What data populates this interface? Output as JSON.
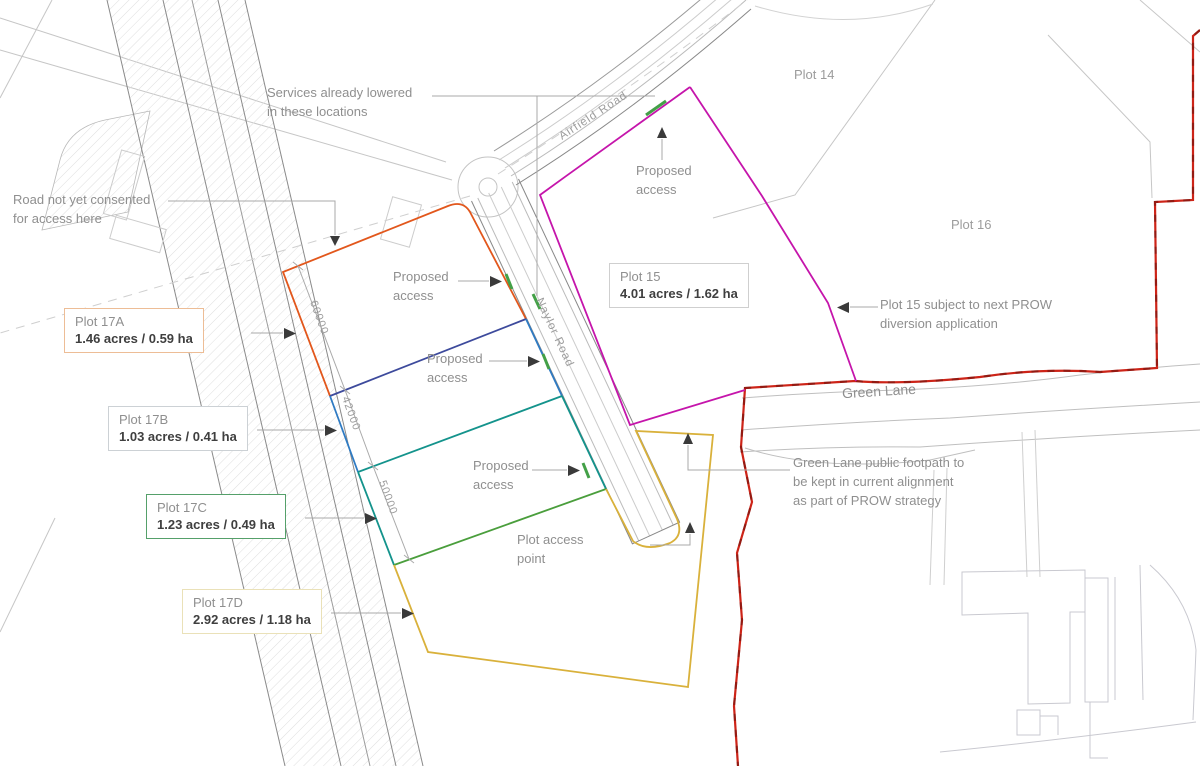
{
  "annotations": {
    "services_note": "Services already lowered\nin these locations",
    "road_note": "Road not yet consented\nfor access here",
    "proposed_access": "Proposed\naccess",
    "plot_access_point": "Plot access\npoint",
    "prow_note": "Plot 15 subject to next PROW\ndiversion application",
    "footpath_note": "Green Lane public footpath to\nbe kept in current alignment\nas part of PROW strategy"
  },
  "roads": {
    "airfield": "Airfield Road",
    "spine": "Naylor Road",
    "green_lane": "Green Lane"
  },
  "plots": {
    "plot14": {
      "label": "Plot 14"
    },
    "plot16": {
      "label": "Plot 16"
    },
    "plot15": {
      "label": "Plot 15",
      "area": "4.01 acres / 1.62 ha",
      "outline": "#c515ab"
    },
    "plot17a": {
      "label": "Plot 17A",
      "area": "1.46 acres / 0.59 ha",
      "outline": "#e2571c"
    },
    "plot17b": {
      "label": "Plot 17B",
      "area": "1.03 acres / 0.41 ha",
      "outline": "#2f7bc3"
    },
    "plot17c": {
      "label": "Plot 17C",
      "area": "1.23 acres / 0.49 ha",
      "outline": "#14938c"
    },
    "plot17d": {
      "label": "Plot 17D",
      "area": "2.92 acres / 1.18 ha",
      "outline": "#d9b13b"
    }
  },
  "dimensions": {
    "d17a": "60000",
    "d17b": "42000",
    "d17c": "50000"
  },
  "colors": {
    "boundary_red": "#cd2418",
    "divider_navy": "#3d4a9c",
    "divider_green": "#4a9e3c",
    "access_tick_green": "#43a047"
  }
}
